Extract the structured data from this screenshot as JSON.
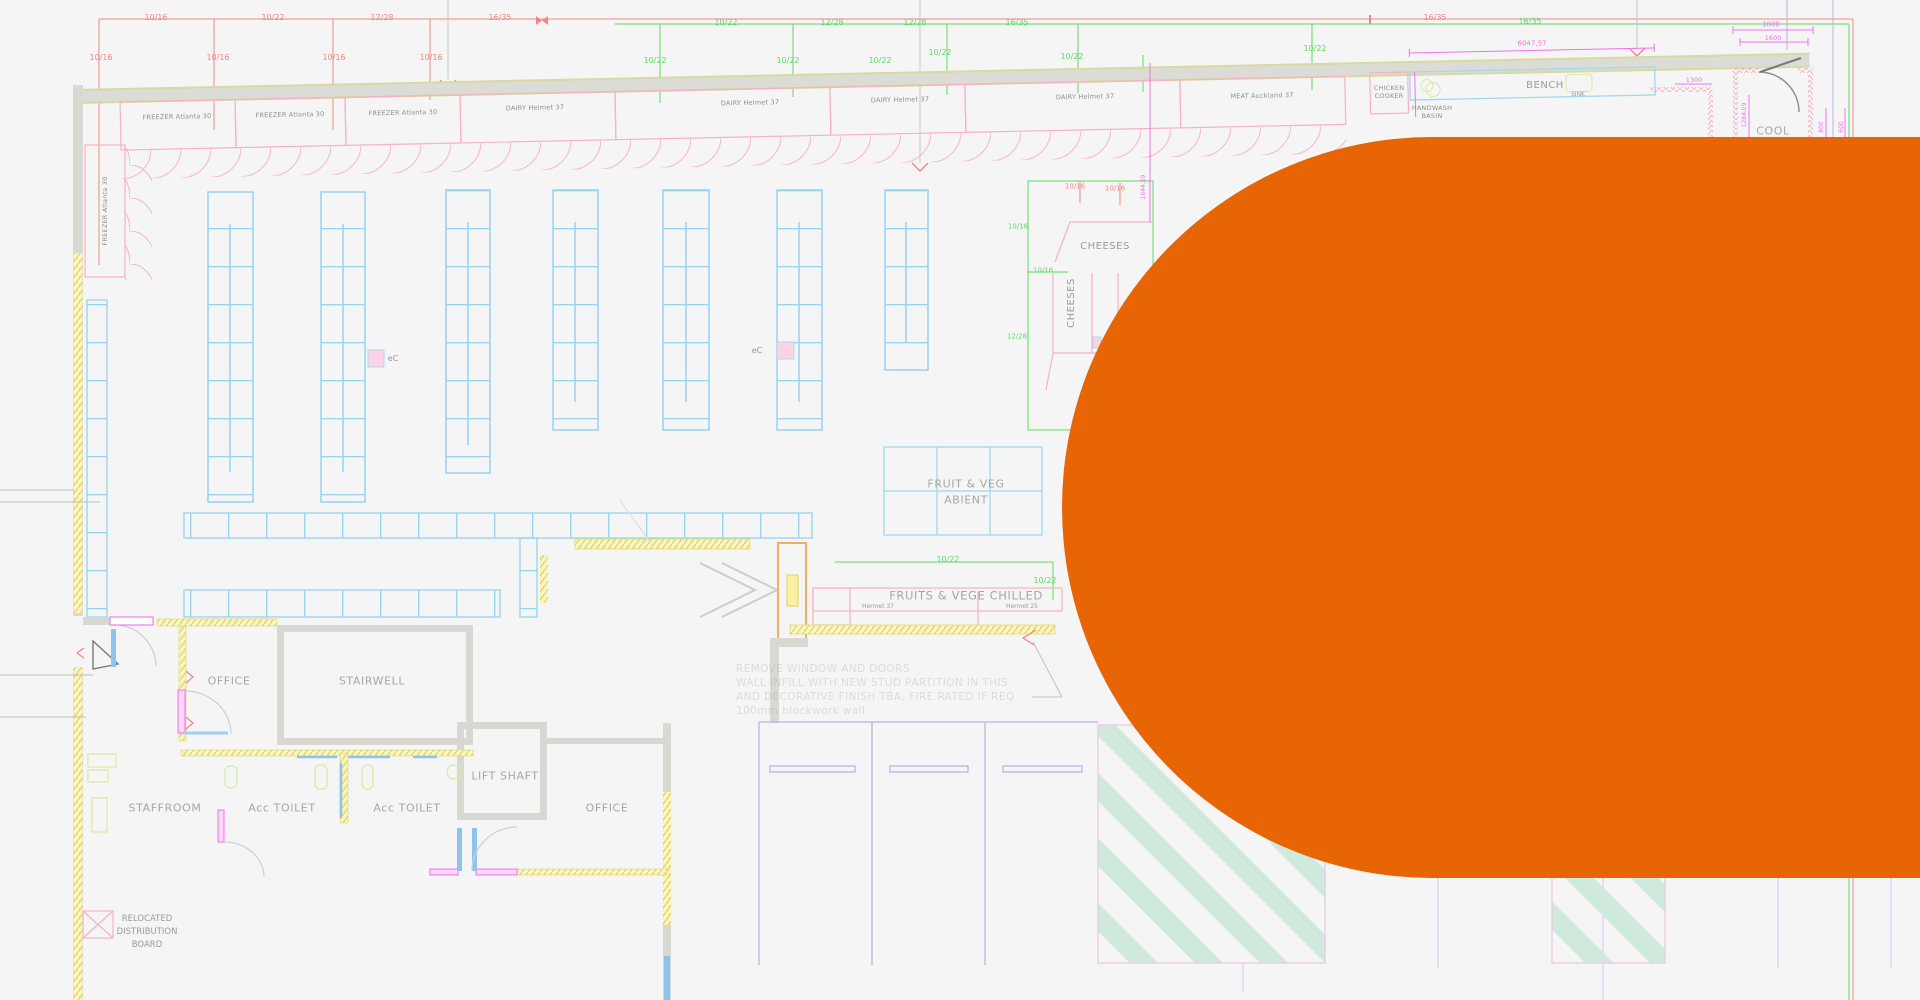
{
  "overlay": {
    "color": "#E76504"
  },
  "dims": {
    "red_top": [
      "10/16",
      "10/22",
      "12/28",
      "16/35",
      "16/35"
    ],
    "red_mid": [
      "10/16",
      "10/16",
      "10/16",
      "10/16"
    ],
    "green_top": [
      "10/22",
      "12/28",
      "12/28",
      "16/35",
      "16/35"
    ],
    "green_mid": [
      "10/22",
      "10/22",
      "10/22",
      "10/22",
      "10/22",
      "10/22"
    ]
  },
  "case_row": {
    "labels": [
      "FREEZER Atlanta 30",
      "FREEZER Atlanta 30",
      "FREEZER Atlanta 30",
      "DAIRY Helmet 37",
      "DAIRY Helmet 37",
      "DAIRY Helmet 37",
      "DAIRY Helmet 37",
      "MEAT Auckland 37"
    ]
  },
  "left_case": {
    "label": "FREEZER Atlanta 30"
  },
  "bench": {
    "label": "BENCH",
    "sink": "SINK",
    "dim": "6047,57"
  },
  "chicken_cooker": {
    "line1": "CHICKEN",
    "line2": "COOKER"
  },
  "handwash": {
    "line1": "HANDWASH",
    "line2": "BASIN"
  },
  "cool_room": {
    "label": "COOL",
    "dim_1800": "1800",
    "dim_1600": "1600",
    "dim_1300": "1300",
    "dim_v1": "1284,09",
    "dim_v2": "800",
    "dim_v3": "600"
  },
  "cheeses": {
    "label_h": "CHEESES",
    "label_v": "CHEESES",
    "dim_red_1": "10/16",
    "dim_red_2": "10/16",
    "dim_green_1": "10/16",
    "dim_green_2": "10/16",
    "dim_green_3": "12/28",
    "dim_magenta": "1644,59"
  },
  "fruit_veg": {
    "line1": "FRUIT & VEG",
    "line2": "ABIENT"
  },
  "chilled": {
    "label": "FRUITS & VEGE CHILLED",
    "left": "Hermet 37",
    "right": "Hermet 25",
    "dim1": "10/22",
    "dim2": "10/22"
  },
  "markers": {
    "ec1": "eC",
    "ec2": "eC"
  },
  "rooms": {
    "office_left": "OFFICE",
    "stairwell": "STAIRWELL",
    "lift_shaft": "LIFT SHAFT",
    "staffroom": "STAFFROOM",
    "toilet_left": "Acc TOILET",
    "toilet_right": "Acc TOILET",
    "office_right": "OFFICE"
  },
  "distribution_board": {
    "line1": "RELOCATED",
    "line2": "DISTRIBUTION",
    "line3": "BOARD"
  },
  "note": {
    "line1": "REMOVE WINDOW AND DOORS",
    "line2": "WALL INFILL WITH NEW STUD PARTITION IN THIS",
    "line3": "AND DECORATIVE FINISH TBA, FIRE RATED IF REQ",
    "line4": "100mm blockwork wall"
  }
}
